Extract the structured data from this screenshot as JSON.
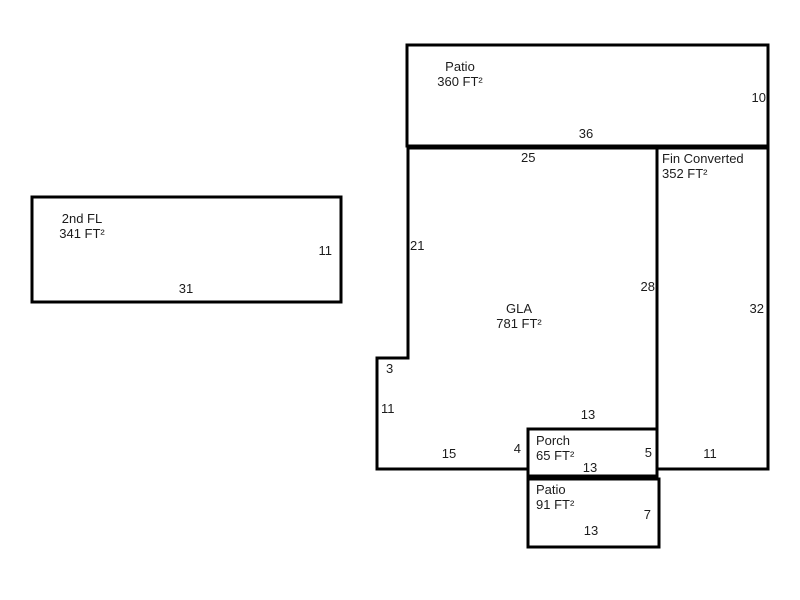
{
  "drawing": {
    "type": "floor-plan-sketch",
    "background": "#ffffff",
    "line_color": "#000000",
    "text_color": "#1c1c1c"
  },
  "areas": {
    "patio_top": {
      "name": "Patio",
      "area": "360 FT²",
      "dim_right": "10",
      "dim_bottom": "36"
    },
    "second_fl": {
      "name": "2nd FL",
      "area": "341 FT²",
      "dim_right": "11",
      "dim_bottom": "31"
    },
    "gla": {
      "name": "GLA",
      "area": "781 FT²",
      "dim_top": "25",
      "dim_left": "21",
      "dim_right": "28",
      "dim_step": "3",
      "dim_left_lower": "11",
      "dim_bottom": "15",
      "dim_bottom_right": "4"
    },
    "fin_converted": {
      "name": "Fin Converted",
      "area": "352 FT²",
      "dim_right": "32",
      "dim_bottom": "11"
    },
    "porch": {
      "name": "Porch",
      "area": "65 FT²",
      "dim_top": "13",
      "dim_right": "5",
      "dim_bottom": "13"
    },
    "patio_bottom": {
      "name": "Patio",
      "area": "91 FT²",
      "dim_right": "7",
      "dim_bottom": "13"
    }
  }
}
